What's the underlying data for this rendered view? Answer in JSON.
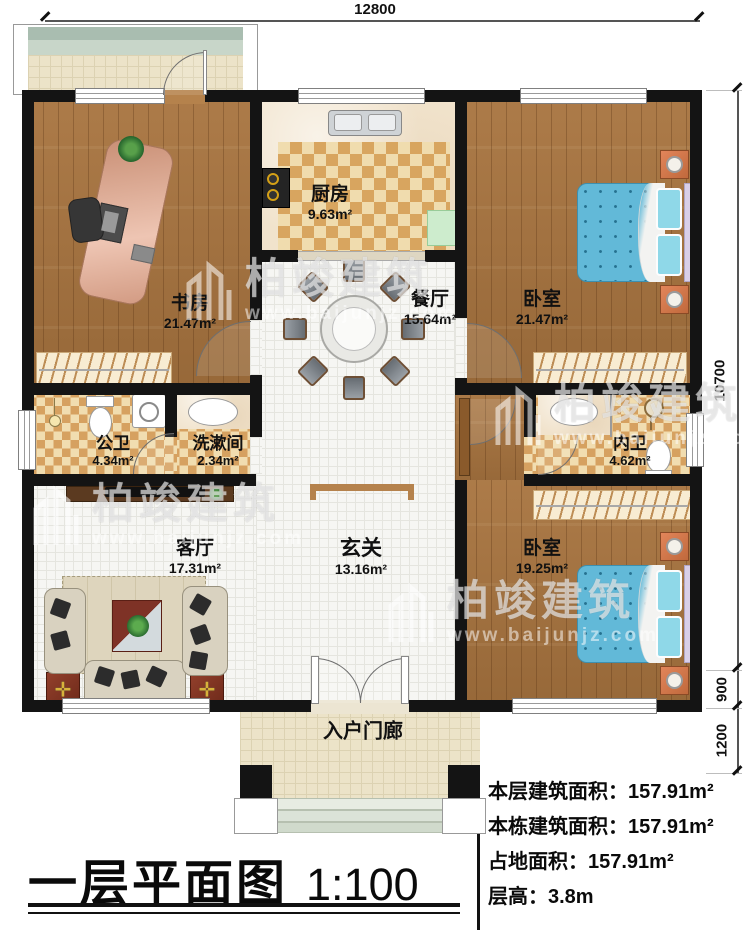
{
  "dims": {
    "top": "12800",
    "side_main": "10700",
    "side_step": "900",
    "side_porch": "1200"
  },
  "rooms": {
    "study": {
      "name": "书房",
      "area": "21.47m²"
    },
    "kitchen": {
      "name": "厨房",
      "area": "9.63m²"
    },
    "dining": {
      "name": "餐厅",
      "area": "15.64m²"
    },
    "bedroom1": {
      "name": "卧室",
      "area": "21.47m²"
    },
    "public_bath": {
      "name": "公卫",
      "area": "4.34m²"
    },
    "washroom": {
      "name": "洗漱间",
      "area": "2.34m²"
    },
    "ensuite_bath": {
      "name": "内卫",
      "area": "4.62m²"
    },
    "living": {
      "name": "客厅",
      "area": "17.31m²"
    },
    "foyer": {
      "name": "玄关",
      "area": "13.16m²"
    },
    "bedroom2": {
      "name": "卧室",
      "area": "19.25m²"
    },
    "porch": {
      "name": "入户门廊"
    }
  },
  "title": {
    "text": "一层平面图",
    "scale": "1:100"
  },
  "stats": [
    {
      "label": "本层建筑面积：",
      "value": "157.91m²"
    },
    {
      "label": "本栋建筑面积：",
      "value": "157.91m²"
    },
    {
      "label": "占地面积：",
      "value": "157.91m²"
    },
    {
      "label": "层高：",
      "value": "3.8m"
    }
  ],
  "watermark": {
    "brand": "柏竣建筑",
    "url": "www.baijunjz.com"
  },
  "icons": {
    "end_table": "✛"
  },
  "colors": {
    "wall": "#141414",
    "wood": "#a8743f",
    "checker_dark": "#d8a55f",
    "checker_light": "#f0dcae",
    "bed_blue": "#62b9d8",
    "door_wood": "#b5824c"
  }
}
